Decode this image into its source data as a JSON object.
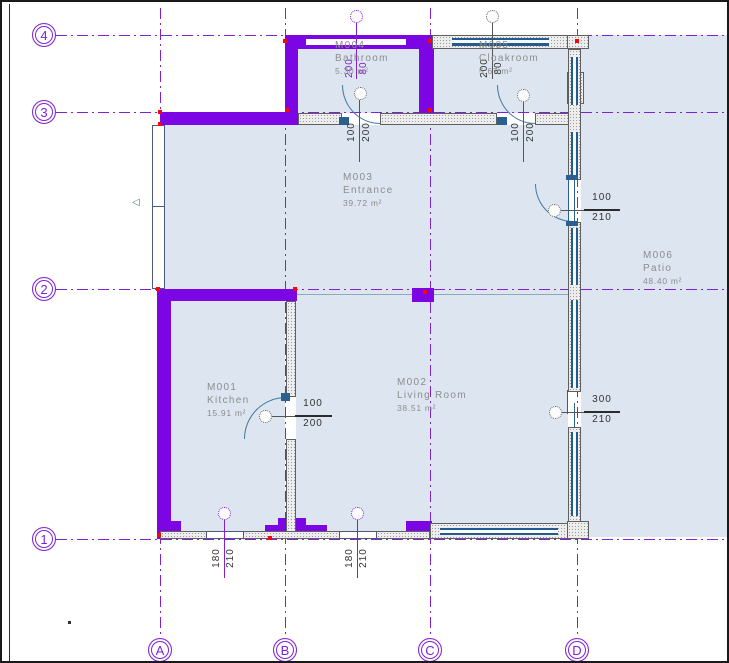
{
  "colors": {
    "selected_wall": "#7b06e3",
    "grid": "#7e22d6",
    "room_fill": "#dce5f0",
    "window": "#255a8c",
    "room_label": "#8d8d8d",
    "dimension_text": "#333333",
    "grip": "#ff0202"
  },
  "grid": {
    "rows": {
      "r4": "4",
      "r3": "3",
      "r2": "2",
      "r1": "1"
    },
    "cols": {
      "A": "A",
      "B": "B",
      "C": "C",
      "D": "D"
    }
  },
  "rooms": {
    "kitchen": {
      "id": "M001",
      "name": "Kitchen",
      "area": "15.91 m²"
    },
    "living": {
      "id": "M002",
      "name": "Living Room",
      "area": "38.51 m²"
    },
    "entrance": {
      "id": "M003",
      "name": "Entrance",
      "area": "39.72 m²"
    },
    "bathroom": {
      "id": "M004",
      "name": "Bathroom",
      "area": "5.30 m²"
    },
    "cloakroom": {
      "id": "M005",
      "name": "Cloakroom",
      "area": "5.67 m²"
    },
    "patio": {
      "id": "M006",
      "name": "Patio",
      "area": "48.40 m²"
    }
  },
  "dimensions": {
    "bathroom_window": {
      "w": "200",
      "h": "80"
    },
    "cloakroom_window": {
      "w": "200",
      "h": "80"
    },
    "bathroom_door": {
      "w": "100",
      "h": "200"
    },
    "cloakroom_door": {
      "w": "100",
      "h": "200"
    },
    "entrance_east_door": {
      "w": "100",
      "h": "210"
    },
    "living_east_door": {
      "w": "300",
      "h": "210"
    },
    "kitchen_door": {
      "w": "100",
      "h": "200"
    },
    "south_window_left": {
      "w": "180",
      "h": "210"
    },
    "south_window_right": {
      "w": "180",
      "h": "210"
    }
  }
}
